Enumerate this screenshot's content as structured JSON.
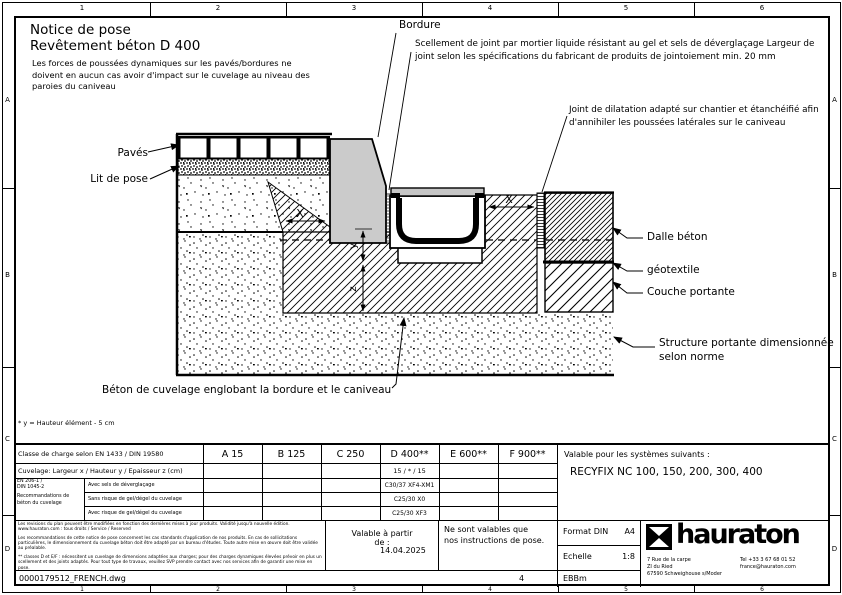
{
  "ruler": {
    "cols": [
      "1",
      "2",
      "3",
      "4",
      "5",
      "6"
    ],
    "rows": [
      "A",
      "B",
      "C",
      "D"
    ]
  },
  "title": {
    "line1": "Notice de pose",
    "line2": "Revêtement béton D 400",
    "description": "Les forces de poussées dynamiques sur les pavés/bordures ne doivent en aucun cas avoir d'impact sur le cuvelage au niveau des paroies du caniveau"
  },
  "annotations": {
    "bordure": "Bordure",
    "scellement": "Scellement de joint par mortier liquide résistant au gel et sels de déverglaçage Largeur de joint selon les spécifications du fabricant de produits de jointoiement min. 20 mm",
    "joint_dilatation": "Joint de dilatation adapté sur chantier et étanchéifié afin d'annihiler les poussées latérales sur le caniveau",
    "paves": "Pavés",
    "lit_de_pose": "Lit de pose",
    "dalle_beton": "Dalle béton",
    "geotextile": "géotextile",
    "couche_portante": "Couche portante",
    "structure_portante": "Structure portante dimensionnée selon norme",
    "beton_cuvelage": "Béton de cuvelage englobant la bordure et le caniveau",
    "footnote": "* y = Hauteur élément - 5 cm",
    "dim_x_left": "X",
    "dim_x_right": "X",
    "dim_y": "y",
    "dim_z": "z"
  },
  "table": {
    "load_class_row_label": "Classe de charge selon EN 1433 / DIN 19580",
    "load_classes": [
      "A 15",
      "B 125",
      "C 250",
      "D 400**",
      "E 600**",
      "F 900**"
    ],
    "cuvelage_row_label": "Cuvelage: Largeur x / Hauteur y / Epaisseur z (cm)",
    "cuvelage_d400": "15 / * / 15",
    "norm_line1": "EN 206-1 /",
    "norm_line2": "DIN 1045-2",
    "norm_caption": "Recommandations de béton du cuvelage",
    "rows": [
      {
        "label": "Avec sels de déverglaçage",
        "d400": "C30/37 XF4-XM1"
      },
      {
        "label": "Sans risque de gel/dégel du cuvelage",
        "d400": "C25/30 X0"
      },
      {
        "label": "Avec risque de gel/dégel du cuvelage",
        "d400": "C25/30 XF3"
      }
    ],
    "valid_systems_label": "Valable pour les systèmes suivants :",
    "valid_systems": "RECYFIX NC 100, 150, 200, 300, 400"
  },
  "titleblock": {
    "legal_p1": "Les revisions du plan peuvent être modifiées en fonction des dernières mises à jour produits. Validité jusqu'à nouvelle édition. www.hauraton.com : tous droits / Service / Reserved",
    "legal_p2": "Les recommandations de cette notice de pose concernent les cas standards d'application de nos produits. En cas de sollicitations particulières, le dimensionnement du cuvelage béton doit être adapté par un bureau d'études. Toute autre mise en œuvre doit être validée au préalable.",
    "legal_p3": "** classes D et E/F : nécessitent un cuvelage de dimensions adaptées aux charges; pour des charges dynamiques élevées prévoir en plus un scellement et des joints adaptés. Pour tout type de travaux, veuillez SVP prendre contact avec nos services afin de garantir une mise en pose.",
    "valid_from_label": "Valable à partir",
    "valid_from_de": "de :",
    "valid_from_date": "14.04.2025",
    "note_line1": "Ne sont valables que",
    "note_line2": "nos instructions de pose.",
    "format_label": "Format DIN",
    "format_value": "A4",
    "scale_label": "Echelle",
    "scale_value": "1:8",
    "brand": "hauraton",
    "address_line1": "7 Rue de la carpe",
    "address_line2": "ZI du Ried",
    "address_line3": "67590 Schweighouse s/Moder",
    "phone": "Tel +33 3 67 68 01 52",
    "email": "france@hauraton.com",
    "drawing_file": "0000179512_FRENCH.dwg",
    "sheet": "4",
    "code": "EBBm"
  },
  "colors": {
    "line": "#000000",
    "curb_gray": "#cbcbcb",
    "grate_gray": "#c6c6c6"
  }
}
